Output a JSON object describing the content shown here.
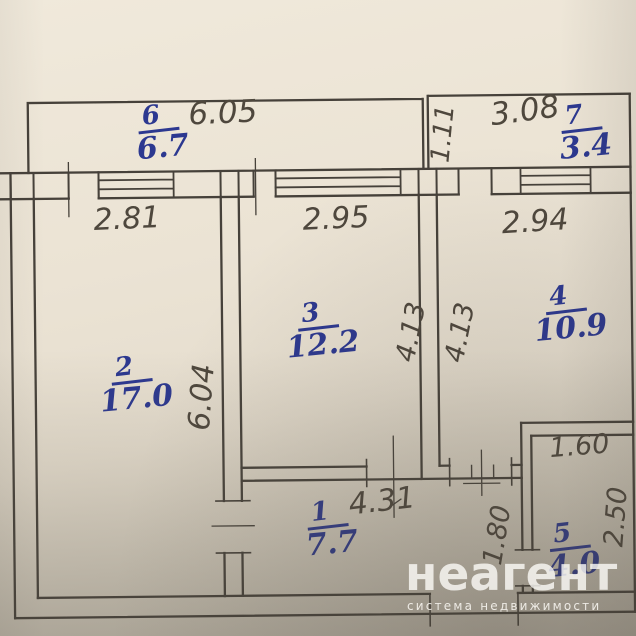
{
  "document_type": "apartment floor plan photo",
  "rooms": [
    {
      "number": "1",
      "area": "7.7"
    },
    {
      "number": "2",
      "area": "17.0"
    },
    {
      "number": "3",
      "area": "12.2"
    },
    {
      "number": "4",
      "area": "10.9"
    },
    {
      "number": "5",
      "area": "4.0"
    },
    {
      "number": "6",
      "area": "6.7"
    },
    {
      "number": "7",
      "area": "3.4"
    }
  ],
  "dims": {
    "balcony6_width": "6.05",
    "balcony7_width": "3.08",
    "balcony7_depth": "1.11",
    "room2_width": "2.81",
    "room3_width": "2.95",
    "room4_width": "2.94",
    "room3_depth": "4.13",
    "room4_depth": "4.13",
    "room2_depth": "6.04",
    "room1_width": "4.31",
    "room1_depth": "1.80",
    "room5_width": "1.60",
    "room5_depth": "2.50"
  },
  "watermark": {
    "brand": "неагент",
    "tagline": "система недвижимости"
  },
  "colors": {
    "ink_blue": "#2c3890",
    "plan_line": "#46413a",
    "paper": "#e9e1d2"
  }
}
